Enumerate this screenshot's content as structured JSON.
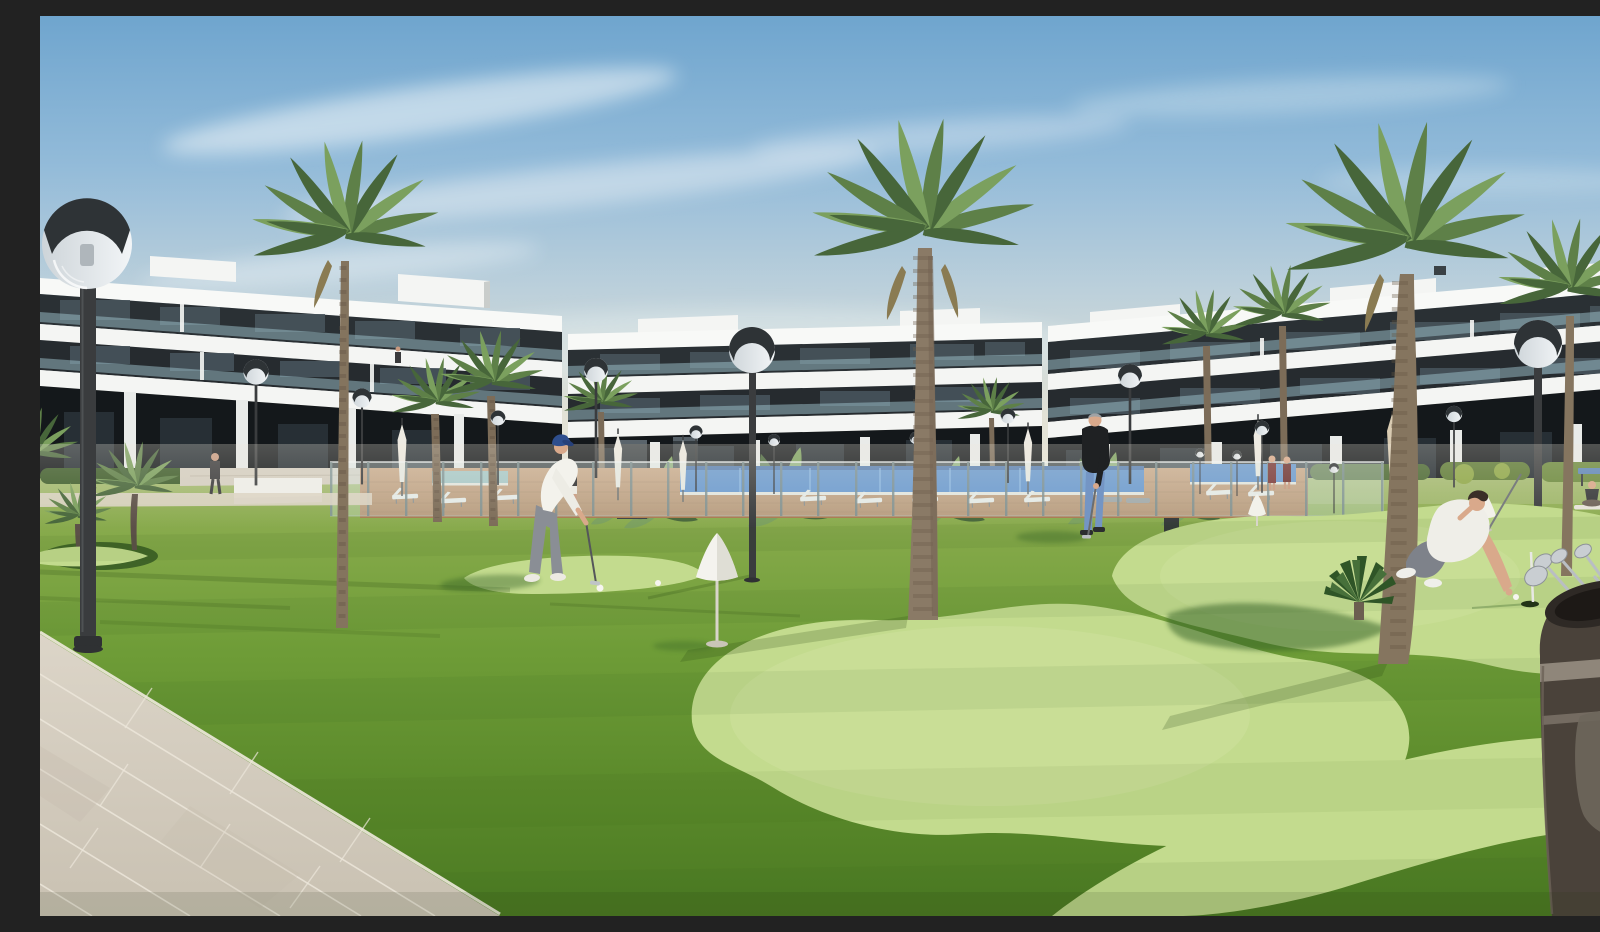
{
  "scene": {
    "type": "architectural-render",
    "setting": "Modern white apartment complex with communal lawn, putting green, swimming pool, palm trees and golfers at golden hour",
    "objects": [
      "sky-with-clouds",
      "apartment-building-left",
      "apartment-building-center",
      "apartment-building-right",
      "palm-trees",
      "banana-plants",
      "hedges",
      "street-lamps",
      "globe-lamp-foreground",
      "glass-pool-fence",
      "swimming-pool",
      "pool-deck",
      "sun-loungers",
      "closed-umbrellas",
      "lawn",
      "putting-green",
      "practice-cones",
      "golf-balls",
      "flagstick-and-hole",
      "golfer-putting",
      "man-standing-with-putter",
      "man-crouching-at-hole",
      "walking-resident",
      "pool-side-women",
      "yoga-woman",
      "table-tennis-table",
      "golf-bag-with-clubs",
      "tiled-walkway",
      "trash-bin",
      "outdoor-pillars"
    ],
    "people_count": 9,
    "cones_count": 3,
    "large_lamps_count": 3
  },
  "palette": {
    "skyTop": "#6FA5CE",
    "skyUpper": "#93BBD9",
    "skyMid": "#BCD0DB",
    "skyLow": "#E2E2D6",
    "skyHorizon": "#ECE9DB",
    "cloud": "#F3F7F9",
    "bldWhite": "#F4F5F3",
    "bldFascia": "#F8F9F7",
    "bldShade": "#E2E6E7",
    "glazing": "#262B2F",
    "glazingB": "#2A3034",
    "winGlass": "#49565E",
    "balcGlass": "#9EC1CC",
    "groundDark": "#14181B",
    "pier": "#E9EBE9",
    "winGlow": "#2C363C",
    "deck": "#C08E60",
    "deckDark": "#9A6F47",
    "pool": "#3B78C4",
    "poolDark": "#24539B",
    "poolLane": "#7FB3E8",
    "poolPale": "#8FC0C4",
    "coping": "#E8E6DC",
    "fenceGlass": "#D8E9EA",
    "fencePost": "#7E9294",
    "fenceRail": "#F4F8F8",
    "grassTop": "#98B25C",
    "grassMid": "#6E9C37",
    "grassLow": "#4B7A22",
    "greenLight": "#C3DB8E",
    "greenLighter": "#D4E6A6",
    "shadowGreen": "#2F5B23",
    "shadowDark": "#24420F",
    "stripeDark": "#2F5418",
    "pathA": "#DCD5C8",
    "pathB": "#C9C1B2",
    "pathJoint": "#EDE7DB",
    "pathCurb": "#F0EADE",
    "beigePath": "#DCD4C4",
    "lampPole": "#3A3C3E",
    "lampCap": "#2E3336",
    "lampGlassTop": "#F2F5F7",
    "lampGlassBot": "#A9B4BB",
    "frond": "#5E8048",
    "frondDark": "#47663A",
    "frondLight": "#7BA05E",
    "deadFrond": "#8A7B52",
    "trunk": "#8A7A66",
    "trunkDark": "#6B5C4C",
    "hedge": "#3E5D2B",
    "hedgeLight": "#5E7B36",
    "bushYellow": "#8FA848",
    "stoneWall": "#D5CFC2",
    "whiteWall": "#EFEFEA",
    "pillarDark": "#3A4145",
    "binDark": "#34383A",
    "coneWhite": "#F4F3EE",
    "coneShade": "#DAD8CE",
    "coneStake": "#D8D5CA",
    "ballWhite": "#F6F5F0",
    "skin": "#D9A98B",
    "hair": "#3A2E28",
    "greyHair": "#9FA3A6",
    "shirtWhite": "#F3F2EC",
    "pantsGrey": "#8A8E95",
    "capBlue": "#2E4E8E",
    "capBrim": "#26407A",
    "shoeWhite": "#ECEAE2",
    "jacketDark": "#1F2123",
    "jeans": "#7495C4",
    "shoeDark": "#2B2D2F",
    "swimRed": "#7A3A3A",
    "yogaDark": "#37393B",
    "tableBlue": "#5E86B8",
    "mat": "#E8E4DA",
    "bagBody": "#4A423A",
    "bagRim": "#2E2925",
    "bagRimIn": "#1D1916",
    "bagStrap": "#978E82",
    "bagPocket": "#6E675C",
    "clubSilver": "#C4C9CD",
    "clubShaft": "#B9BEC3",
    "flagPoleWhite": "#E8E8E4",
    "holeDark": "#233318",
    "loungerWhite": "#ECECE8",
    "loungerLeg": "#6B6E70",
    "umbrellaCream": "#EDEAE2",
    "umbrellaTan": "#D9CBB2"
  }
}
